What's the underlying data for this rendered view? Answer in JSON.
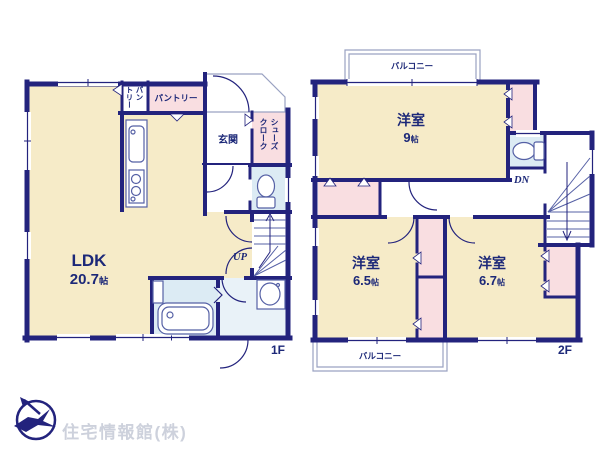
{
  "floor_labels": {
    "first": "1F",
    "second": "2F"
  },
  "rooms": {
    "ldk": {
      "name": "LDK",
      "size": "20.7",
      "unit": "帖"
    },
    "pantry": {
      "label": "パントリー",
      "vertical_right": "パン",
      "vertical_left": "トリー"
    },
    "genkan": {
      "label": "玄関"
    },
    "shoes_closet": {
      "label": "シューズクローク"
    },
    "western9": {
      "name": "洋室",
      "size": "9",
      "unit": "帖"
    },
    "western65": {
      "name": "洋室",
      "size": "6.5",
      "unit": "帖"
    },
    "western67": {
      "name": "洋室",
      "size": "6.7",
      "unit": "帖"
    },
    "balcony": {
      "label": "バルコニー"
    }
  },
  "stairs": {
    "up": "UP",
    "down": "DN"
  },
  "footer": {
    "company": "住宅情報館(株)"
  },
  "colors": {
    "wall": "#23237d",
    "room_cream": "#f6ebc8",
    "room_pink": "#f9dee1",
    "room_blue": "#dcebf4",
    "room_blue_light": "#e9f2f8",
    "text": "#1c2878",
    "thin_outline": "#9aa2c2",
    "watermark": "#cdd1dc"
  }
}
